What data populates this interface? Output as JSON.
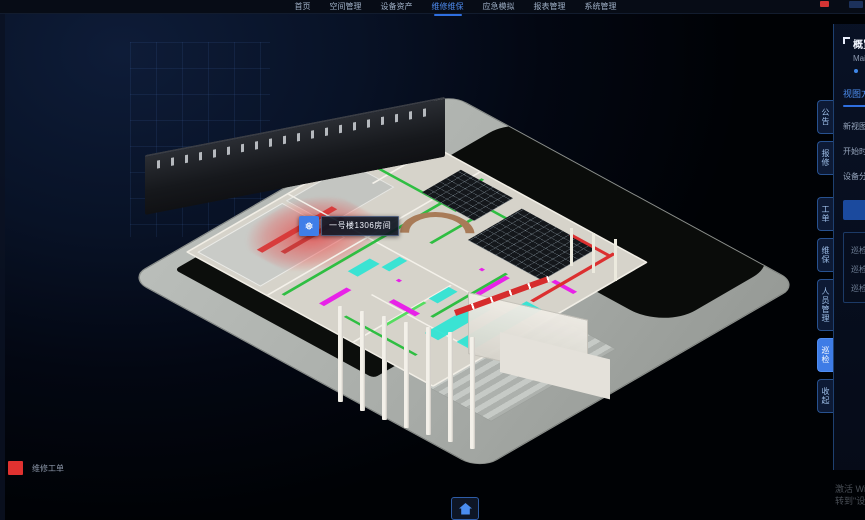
{
  "nav": {
    "items": [
      {
        "label": "首页",
        "active": false
      },
      {
        "label": "空间管理",
        "active": false
      },
      {
        "label": "设备资产",
        "active": false
      },
      {
        "label": "维修维保",
        "active": true
      },
      {
        "label": "应急模拟",
        "active": false
      },
      {
        "label": "报表管理",
        "active": false
      },
      {
        "label": "系统管理",
        "active": false
      }
    ]
  },
  "side_tabs": {
    "items": [
      "公告",
      "报修",
      "工单",
      "维保",
      "人员管理",
      "巡检",
      "收起"
    ],
    "active": "巡检"
  },
  "panel": {
    "title": "概览",
    "subtitle": "Main",
    "tab": "视图方案",
    "rows": [
      "新视图层",
      "开始时间",
      "设备分布"
    ],
    "button": "查看详情",
    "list": [
      "巡检点位",
      "巡检路线",
      "巡检人员"
    ]
  },
  "tooltip": {
    "icon": "snowflake-icon",
    "icon_glyph": "❅",
    "text": "一号楼1306房间"
  },
  "legend": {
    "label": "维修工单",
    "color": "#e03230"
  },
  "watermark": {
    "line1": "激活 Windows",
    "line2": "转到\"设置\"以激活 Windows。"
  },
  "colors": {
    "accent": "#3f7ee8",
    "pipe_green": "#2fbe42",
    "duct_magenta": "#e822e8",
    "glass_cyan": "#2de4d4",
    "alert_red": "#e03230"
  }
}
